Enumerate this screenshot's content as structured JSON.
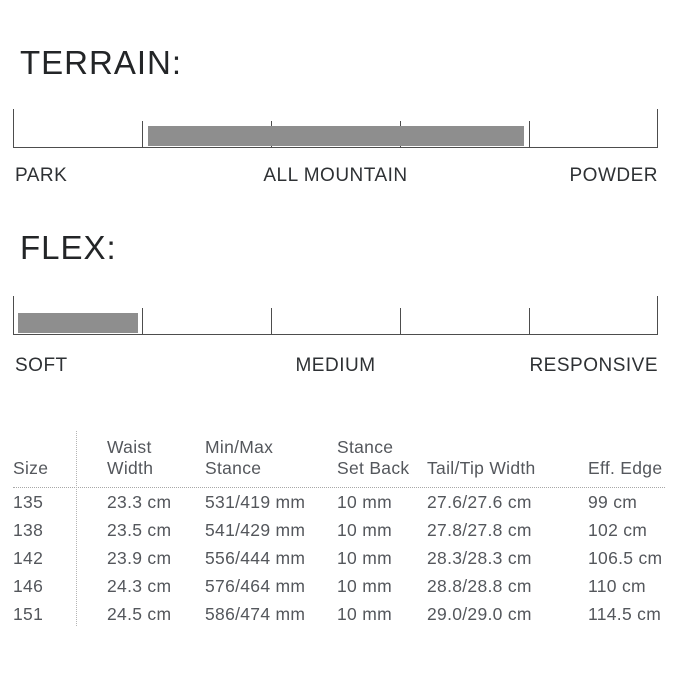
{
  "colors": {
    "background": "#ffffff",
    "title_text": "#232527",
    "scale_label_text": "#2e3134",
    "axis_line": "#4d4d4d",
    "rating_bar": "#8e8e8e",
    "table_text": "#54575c",
    "dotted_divider": "#a8a8a8"
  },
  "terrain": {
    "title": "TERRAIN:",
    "labels": [
      "PARK",
      "ALL MOUNTAIN",
      "POWDER"
    ],
    "bar": {
      "left_pct": 20.9,
      "width_pct": 58.3
    }
  },
  "flex": {
    "title": "FLEX:",
    "labels": [
      "SOFT",
      "MEDIUM",
      "RESPONSIVE"
    ],
    "bar": {
      "left_pct": 0.8,
      "width_pct": 18.6
    }
  },
  "table": {
    "headers": [
      "Size",
      "Waist\nWidth",
      "Min/Max\nStance",
      "Stance\nSet Back",
      "Tail/Tip Width",
      "Eff. Edge"
    ],
    "rows": [
      [
        "135",
        "23.3 cm",
        "531/419 mm",
        "10 mm",
        "27.6/27.6 cm",
        "99 cm"
      ],
      [
        "138",
        "23.5 cm",
        "541/429 mm",
        "10 mm",
        "27.8/27.8 cm",
        "102 cm"
      ],
      [
        "142",
        "23.9 cm",
        "556/444 mm",
        "10 mm",
        "28.3/28.3 cm",
        "106.5 cm"
      ],
      [
        "146",
        "24.3 cm",
        "576/464 mm",
        "10 mm",
        "28.8/28.8 cm",
        "110 cm"
      ],
      [
        "151",
        "24.5 cm",
        "586/474 mm",
        "10 mm",
        "29.0/29.0 cm",
        "114.5 cm"
      ]
    ]
  },
  "chart_data": [
    {
      "type": "bar",
      "title": "TERRAIN",
      "orientation": "horizontal-gauge",
      "axis_range": [
        0,
        5
      ],
      "tick_count": 6,
      "tick_labels": [
        "PARK",
        "ALL MOUNTAIN",
        "POWDER"
      ],
      "tick_label_positions": [
        "left-end",
        "center",
        "right-end"
      ],
      "bar_span": [
        1.05,
        3.95
      ],
      "grid": false,
      "legend": "none"
    },
    {
      "type": "bar",
      "title": "FLEX",
      "orientation": "horizontal-gauge",
      "axis_range": [
        0,
        5
      ],
      "tick_count": 6,
      "tick_labels": [
        "SOFT",
        "MEDIUM",
        "RESPONSIVE"
      ],
      "tick_label_positions": [
        "left-end",
        "center",
        "right-end"
      ],
      "bar_span": [
        0.04,
        0.97
      ],
      "grid": false,
      "legend": "none"
    },
    {
      "type": "table",
      "title": "Size specifications",
      "columns": [
        "Size",
        "Waist Width",
        "Min/Max Stance",
        "Stance Set Back",
        "Tail/Tip Width",
        "Eff. Edge"
      ],
      "rows": [
        [
          "135",
          "23.3 cm",
          "531/419 mm",
          "10 mm",
          "27.6/27.6 cm",
          "99 cm"
        ],
        [
          "138",
          "23.5 cm",
          "541/429 mm",
          "10 mm",
          "27.8/27.8 cm",
          "102 cm"
        ],
        [
          "142",
          "23.9 cm",
          "556/444 mm",
          "10 mm",
          "28.3/28.3 cm",
          "106.5 cm"
        ],
        [
          "146",
          "24.3 cm",
          "576/464 mm",
          "10 mm",
          "28.8/28.8 cm",
          "110 cm"
        ],
        [
          "151",
          "24.5 cm",
          "586/474 mm",
          "10 mm",
          "29.0/29.0 cm",
          "114.5 cm"
        ]
      ]
    }
  ]
}
